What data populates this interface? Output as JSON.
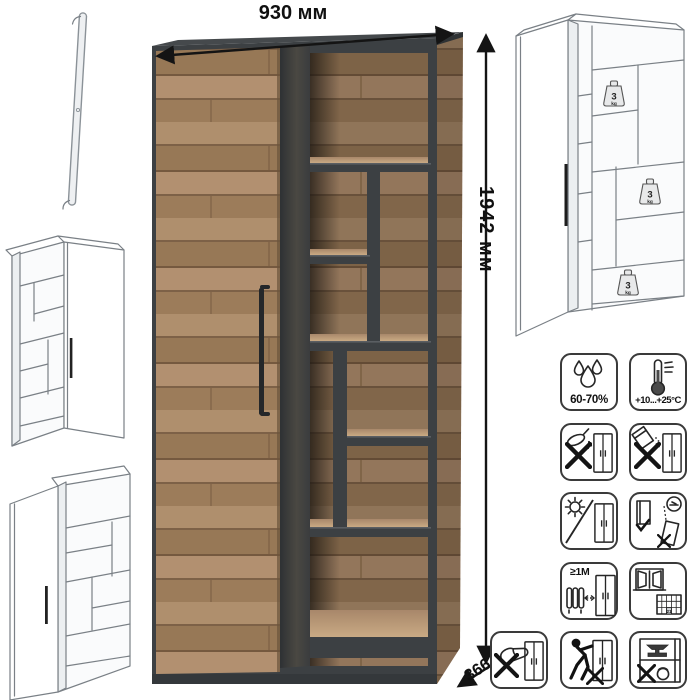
{
  "dimensions": {
    "width": "930 мм",
    "height": "1942 мм",
    "depth": "366 мм"
  },
  "loads": [
    {
      "value": "3",
      "unit": "kg"
    },
    {
      "value": "3",
      "unit": "kg"
    },
    {
      "value": "3",
      "unit": "kg"
    }
  ],
  "care_icons": [
    {
      "name": "humidity-drops-icon",
      "label": "60-70%"
    },
    {
      "name": "thermometer-icon",
      "label": "+10...+25°C"
    },
    {
      "name": "no-liquid-spill-icon"
    },
    {
      "name": "no-abrasive-powder-icon"
    },
    {
      "name": "no-direct-sunlight-icon"
    },
    {
      "name": "anchor-to-wall-icon"
    },
    {
      "name": "heater-distance-icon",
      "label": "≥1М"
    },
    {
      "name": "ventilate-room-icon",
      "label": "21"
    },
    {
      "name": "no-shoe-impact-icon"
    },
    {
      "name": "no-push-drag-icon"
    },
    {
      "name": "no-overload-icon"
    }
  ],
  "colors": {
    "wood_light": "#b29070",
    "wood_mid": "#9c7c5a",
    "wood_dark": "#7d6147",
    "frame_graphite": "#3e4245",
    "line_grey": "#7a8086"
  }
}
